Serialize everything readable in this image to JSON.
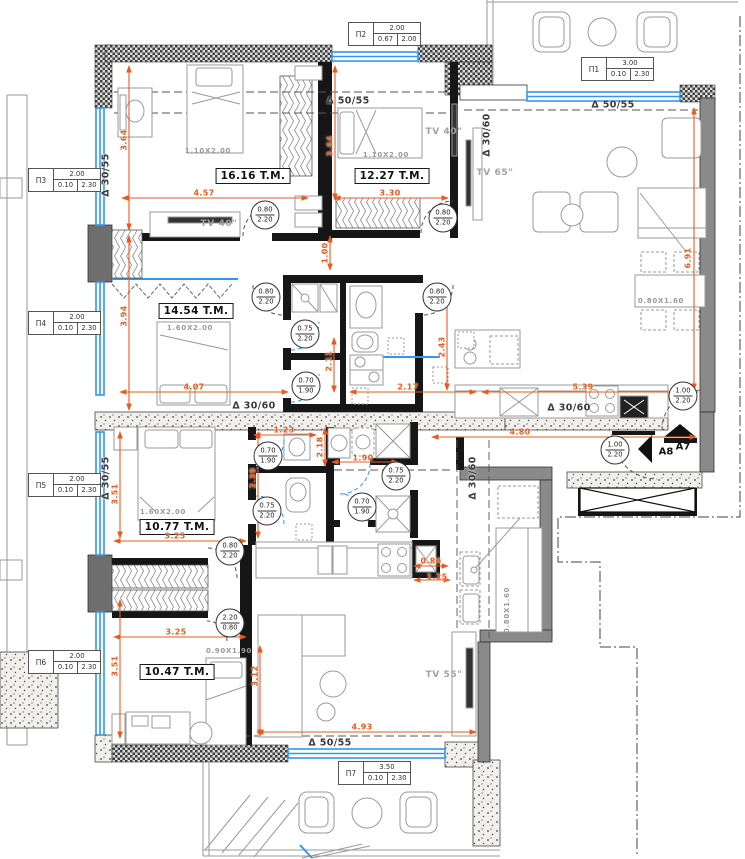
{
  "colors": {
    "dimension": "#ea5a1e",
    "window": "#2f97f2",
    "wall": "#161616",
    "concrete": "#9a9a9a"
  },
  "window_tags": [
    {
      "id": "П2",
      "width": "2.00",
      "sill": "0.67",
      "height": "2.00"
    },
    {
      "id": "П1",
      "width": "3.00",
      "sill": "0.10",
      "height": "2.30"
    },
    {
      "id": "П3",
      "width": "2.00",
      "sill": "0.10",
      "height": "2.30"
    },
    {
      "id": "П4",
      "width": "2.00",
      "sill": "0.10",
      "height": "2.30"
    },
    {
      "id": "П5",
      "width": "2.00",
      "sill": "0.10",
      "height": "2.30"
    },
    {
      "id": "П6",
      "width": "2.00",
      "sill": "0.10",
      "height": "2.30"
    },
    {
      "id": "П7",
      "width": "3.50",
      "sill": "0.10",
      "height": "2.30"
    }
  ],
  "room_labels": [
    "16.16 T.M.",
    "12.27 T.M.",
    "14.54 T.M.",
    "10.77 T.M.",
    "10.47 T.M."
  ],
  "beam_labels": [
    {
      "t": "Δ 50/55"
    },
    {
      "t": "Δ 50/55"
    },
    {
      "t": "Δ 30/55"
    },
    {
      "t": "Δ 30/60"
    },
    {
      "t": "Δ 30/60"
    },
    {
      "t": "Δ 30/60"
    },
    {
      "t": "Δ 30/55"
    },
    {
      "t": "Δ 30/60"
    },
    {
      "t": "Δ 50/55"
    }
  ],
  "door_tags": [
    {
      "w": "0.80",
      "h": "2.20"
    },
    {
      "w": "0.80",
      "h": "2.20"
    },
    {
      "w": "0.80",
      "h": "2.20"
    },
    {
      "w": "0.80",
      "h": "2.20"
    },
    {
      "w": "0.75",
      "h": "2.20"
    },
    {
      "w": "0.70",
      "h": "1.90"
    },
    {
      "w": "1.00",
      "h": "2.20"
    },
    {
      "w": "1.00",
      "h": "2.20"
    },
    {
      "w": "0.70",
      "h": "1.90"
    },
    {
      "w": "0.75",
      "h": "2.20"
    },
    {
      "w": "0.75",
      "h": "2.20"
    },
    {
      "w": "0.70",
      "h": "1.90"
    },
    {
      "w": "0.80",
      "h": "2.20"
    },
    {
      "w": "2.20",
      "h": "0.80"
    }
  ],
  "dimensions": [
    {
      "v": "4.57"
    },
    {
      "v": "3.30"
    },
    {
      "v": "3.64"
    },
    {
      "v": "3.64"
    },
    {
      "v": "3.94"
    },
    {
      "v": "4.07"
    },
    {
      "v": "2.17"
    },
    {
      "v": "2.11"
    },
    {
      "v": "2.43"
    },
    {
      "v": "5.39"
    },
    {
      "v": "6.91"
    },
    {
      "v": "4.80"
    },
    {
      "v": "1.23"
    },
    {
      "v": "1.90"
    },
    {
      "v": "2.39"
    },
    {
      "v": "3.51"
    },
    {
      "v": "2.18"
    },
    {
      "v": "3.25"
    },
    {
      "v": "0.86"
    },
    {
      "v": "1.25"
    },
    {
      "v": "3.25"
    },
    {
      "v": "3.51"
    },
    {
      "v": "3.12"
    },
    {
      "v": "4.93"
    },
    {
      "v": "1.00"
    }
  ],
  "furniture_labels": [
    "1.10X2.00",
    "1.10X2.00",
    "1.60X2.00",
    "1.60X2.00",
    "0.90X1.90",
    "0.80X1.60",
    "0.80X1.60"
  ],
  "tv_labels": [
    "TV 40\"",
    "TV 40\"",
    "TV 65\"",
    "TV 55\""
  ],
  "section_marks": [
    "A7",
    "A8"
  ]
}
